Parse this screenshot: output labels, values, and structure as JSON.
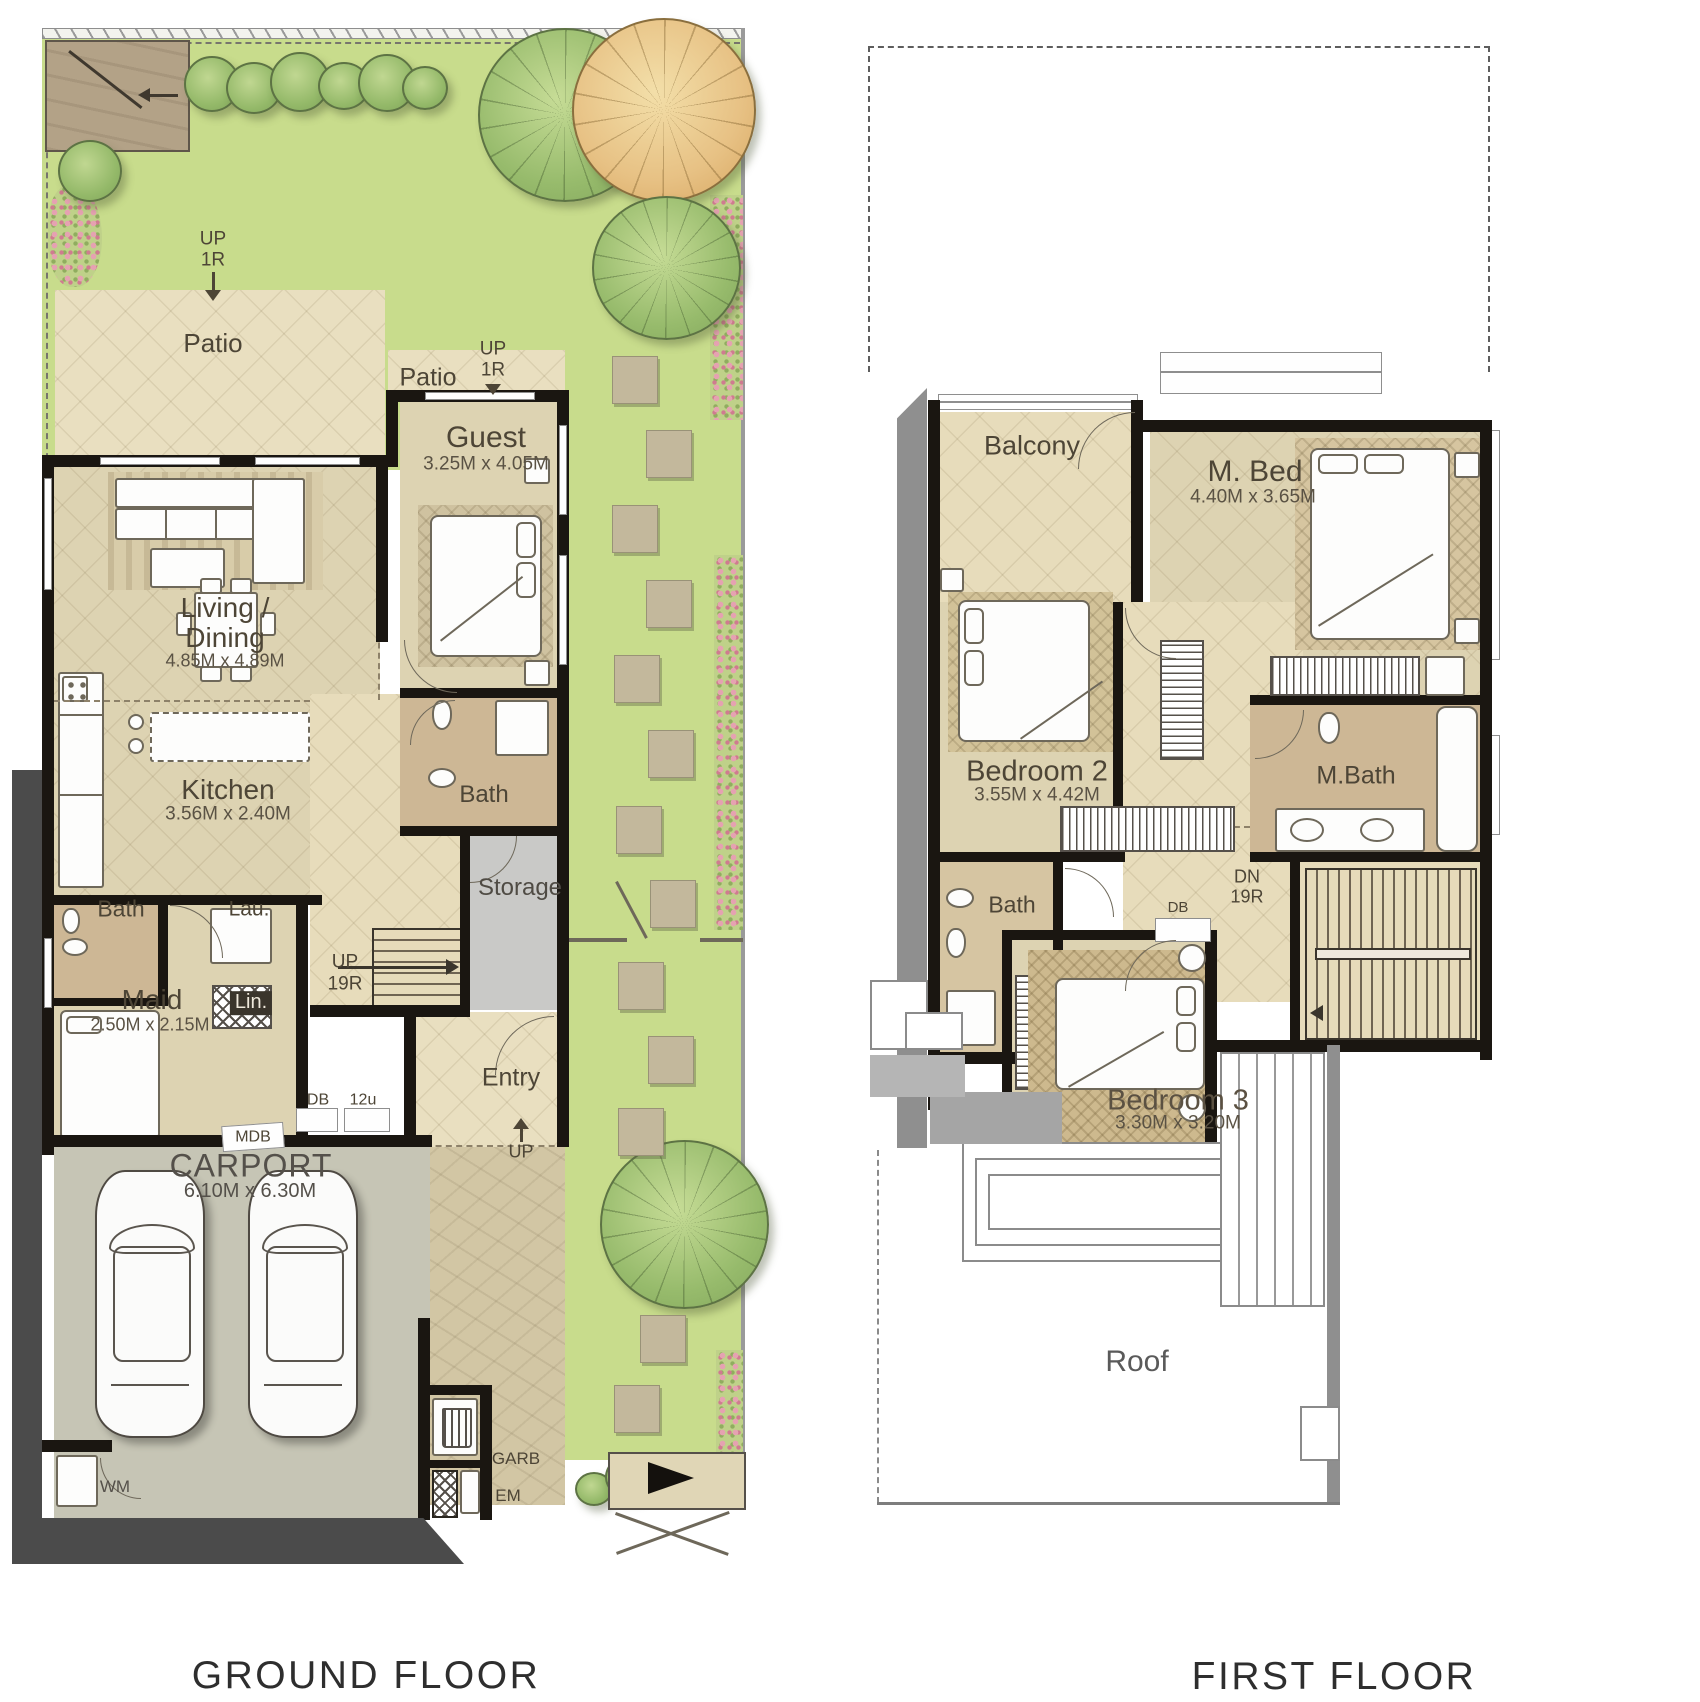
{
  "page": {
    "background": "#ffffff"
  },
  "palette": {
    "grass": "#c8dc8c",
    "patio": "#e9dfc0",
    "room_floor": "#ddd3b2",
    "bath_tile": "#cdb795",
    "wall": "#1a1611",
    "site_border_dark": "#4b4b4b",
    "carport_floor": "#c6c5b5",
    "storage_gray": "#c9c9c7",
    "tree_green": "#94b969",
    "tree_orange": "#e7c184",
    "flowers_pink": "#e5a2b1",
    "first_floor_band": "#8f8f8f",
    "label_text": "#4d4536"
  },
  "ground_floor": {
    "caption": "GROUND FLOOR",
    "rooms": {
      "patio_main": {
        "label": "Patio"
      },
      "patio_guest": {
        "label": "Patio"
      },
      "guest": {
        "label": "Guest",
        "dims": "3.25M x 4.05M"
      },
      "living_dining": {
        "label1": "Living /",
        "label2": "Dining",
        "dims": "4.85M x 4.89M"
      },
      "kitchen": {
        "label": "Kitchen",
        "dims": "3.56M x 2.40M"
      },
      "guest_bath": {
        "label": "Bath"
      },
      "storage": {
        "label": "Storage"
      },
      "maid_bath": {
        "label": "Bath"
      },
      "laundry": {
        "label": "Lau."
      },
      "maid": {
        "label": "Maid",
        "dims": "2.50M x 2.15M"
      },
      "linen": {
        "label": "Lin."
      },
      "entry": {
        "label": "Entry"
      },
      "carport": {
        "label": "CARPORT",
        "dims": "6.10M x 6.30M"
      }
    },
    "annotations": {
      "up_garden": {
        "line1": "UP",
        "line2": "1R"
      },
      "up_patio": {
        "line1": "UP",
        "line2": "1R"
      },
      "up_stairs": {
        "line1": "UP",
        "line2": "19R"
      },
      "up_entry": "UP",
      "db": "DB",
      "db_units": "12u",
      "mdb": "MDB",
      "wm": "WM",
      "garb": "GARB",
      "em": "EM"
    }
  },
  "first_floor": {
    "caption": "FIRST FLOOR",
    "rooms": {
      "balcony": {
        "label": "Balcony"
      },
      "master_bed": {
        "label": "M. Bed",
        "dims": "4.40M x 3.65M"
      },
      "bedroom2": {
        "label": "Bedroom 2",
        "dims": "3.55M x 4.42M"
      },
      "master_bath": {
        "label": "M.Bath"
      },
      "bath": {
        "label": "Bath"
      },
      "bedroom3": {
        "label": "Bedroom 3",
        "dims": "3.30M x 3.20M"
      },
      "roof": {
        "label": "Roof"
      }
    },
    "annotations": {
      "dn_stairs": {
        "line1": "DN",
        "line2": "19R"
      },
      "db": "DB"
    }
  }
}
